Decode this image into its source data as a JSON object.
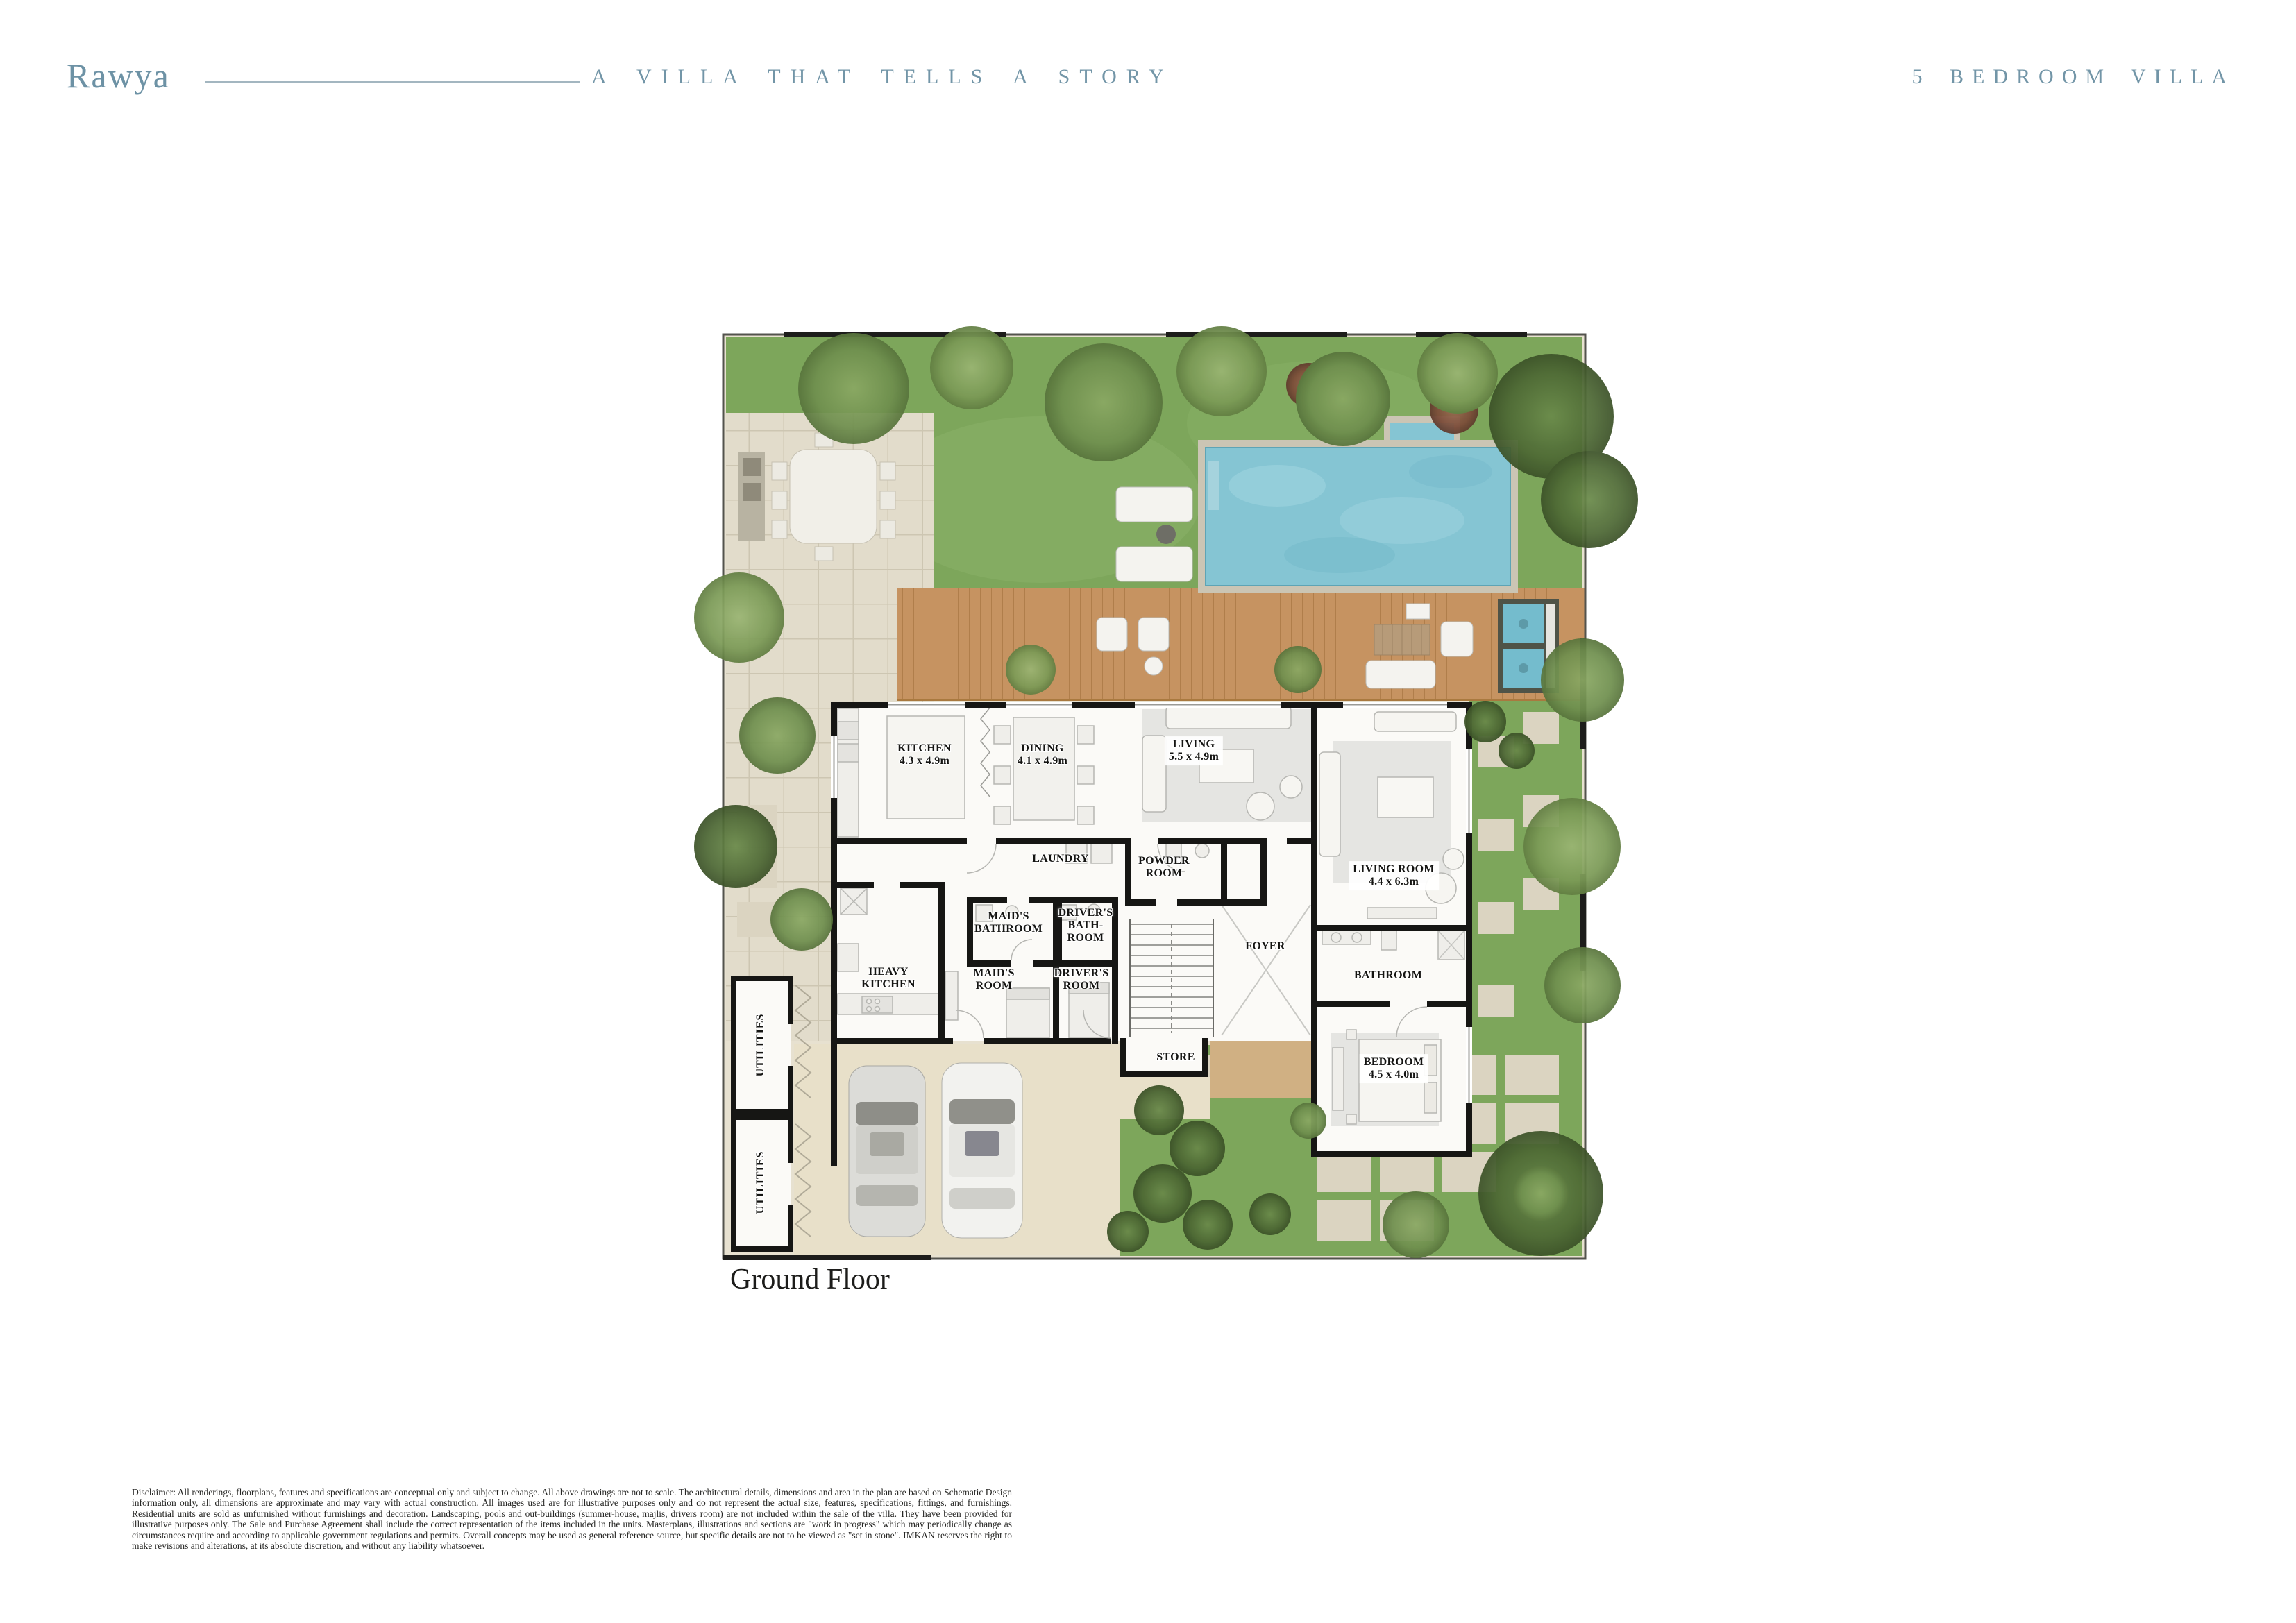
{
  "header": {
    "brand": "Rawya",
    "tagline": "A VILLA THAT TELLS A STORY",
    "unit_type": "5 BEDROOM VILLA"
  },
  "plan": {
    "floor_label": "Ground Floor",
    "rooms": {
      "kitchen": {
        "label": "KITCHEN",
        "dims": "4.3 x 4.9m"
      },
      "dining": {
        "label": "DINING",
        "dims": "4.1 x 4.9m"
      },
      "living": {
        "label": "LIVING",
        "dims": "5.5 x 4.9m"
      },
      "living_room": {
        "label": "LIVING ROOM",
        "dims": "4.4 x 6.3m"
      },
      "laundry": {
        "label": "LAUNDRY",
        "dims": ""
      },
      "powder_room": {
        "label": "POWDER ROOM",
        "dims": ""
      },
      "maids_bathroom": {
        "label": "MAID'S BATHROOM",
        "dims": ""
      },
      "drivers_bathroom": {
        "label": "DRIVER'S BATH-ROOM",
        "dims": ""
      },
      "heavy_kitchen": {
        "label": "HEAVY KITCHEN",
        "dims": ""
      },
      "maids_room": {
        "label": "MAID'S ROOM",
        "dims": ""
      },
      "drivers_room": {
        "label": "DRIVER'S ROOM",
        "dims": ""
      },
      "foyer": {
        "label": "FOYER",
        "dims": ""
      },
      "bathroom": {
        "label": "BATHROOM",
        "dims": ""
      },
      "store": {
        "label": "STORE",
        "dims": ""
      },
      "bedroom": {
        "label": "BEDROOM",
        "dims": "4.5 x 4.0m"
      },
      "utilities_a": {
        "label": "UTILITIES",
        "dims": ""
      },
      "utilities_b": {
        "label": "UTILITIES",
        "dims": ""
      }
    }
  },
  "footer": {
    "disclaimer": "Disclaimer: All renderings, floorplans, features and specifications are conceptual only and subject to change. All above drawings are not to scale. The architectural details, dimensions and area in the plan are based on Schematic Design information only, all dimensions are approximate and may vary with actual construction. All images used are for illustrative purposes only and do not represent the actual size, features, specifications, fittings, and furnishings. Residential units are sold as unfurnished without furnishings and decoration. Landscaping, pools and out-buildings (summer-house, majlis, drivers room) are not included within the sale of the villa. They have been provided for illustrative purposes only. The Sale and Purchase Agreement shall include the correct representation of the items included in the units. Masterplans, illustrations and sections are \"work in progress\" which may periodically change as circumstances require and according to applicable government regulations and permits. Overall concepts may be used as general reference source, but specific details are not to be viewed as \"set in stone\". IMKAN reserves the right to make revisions and alterations, at its absolute discretion, and without any liability whatsoever."
  },
  "colors": {
    "brand_blue": "#6d92a5",
    "lawn_green": "#7da65b",
    "pool_blue": "#85c5d3",
    "deck_wood": "#c69361",
    "wall_black": "#161614"
  }
}
